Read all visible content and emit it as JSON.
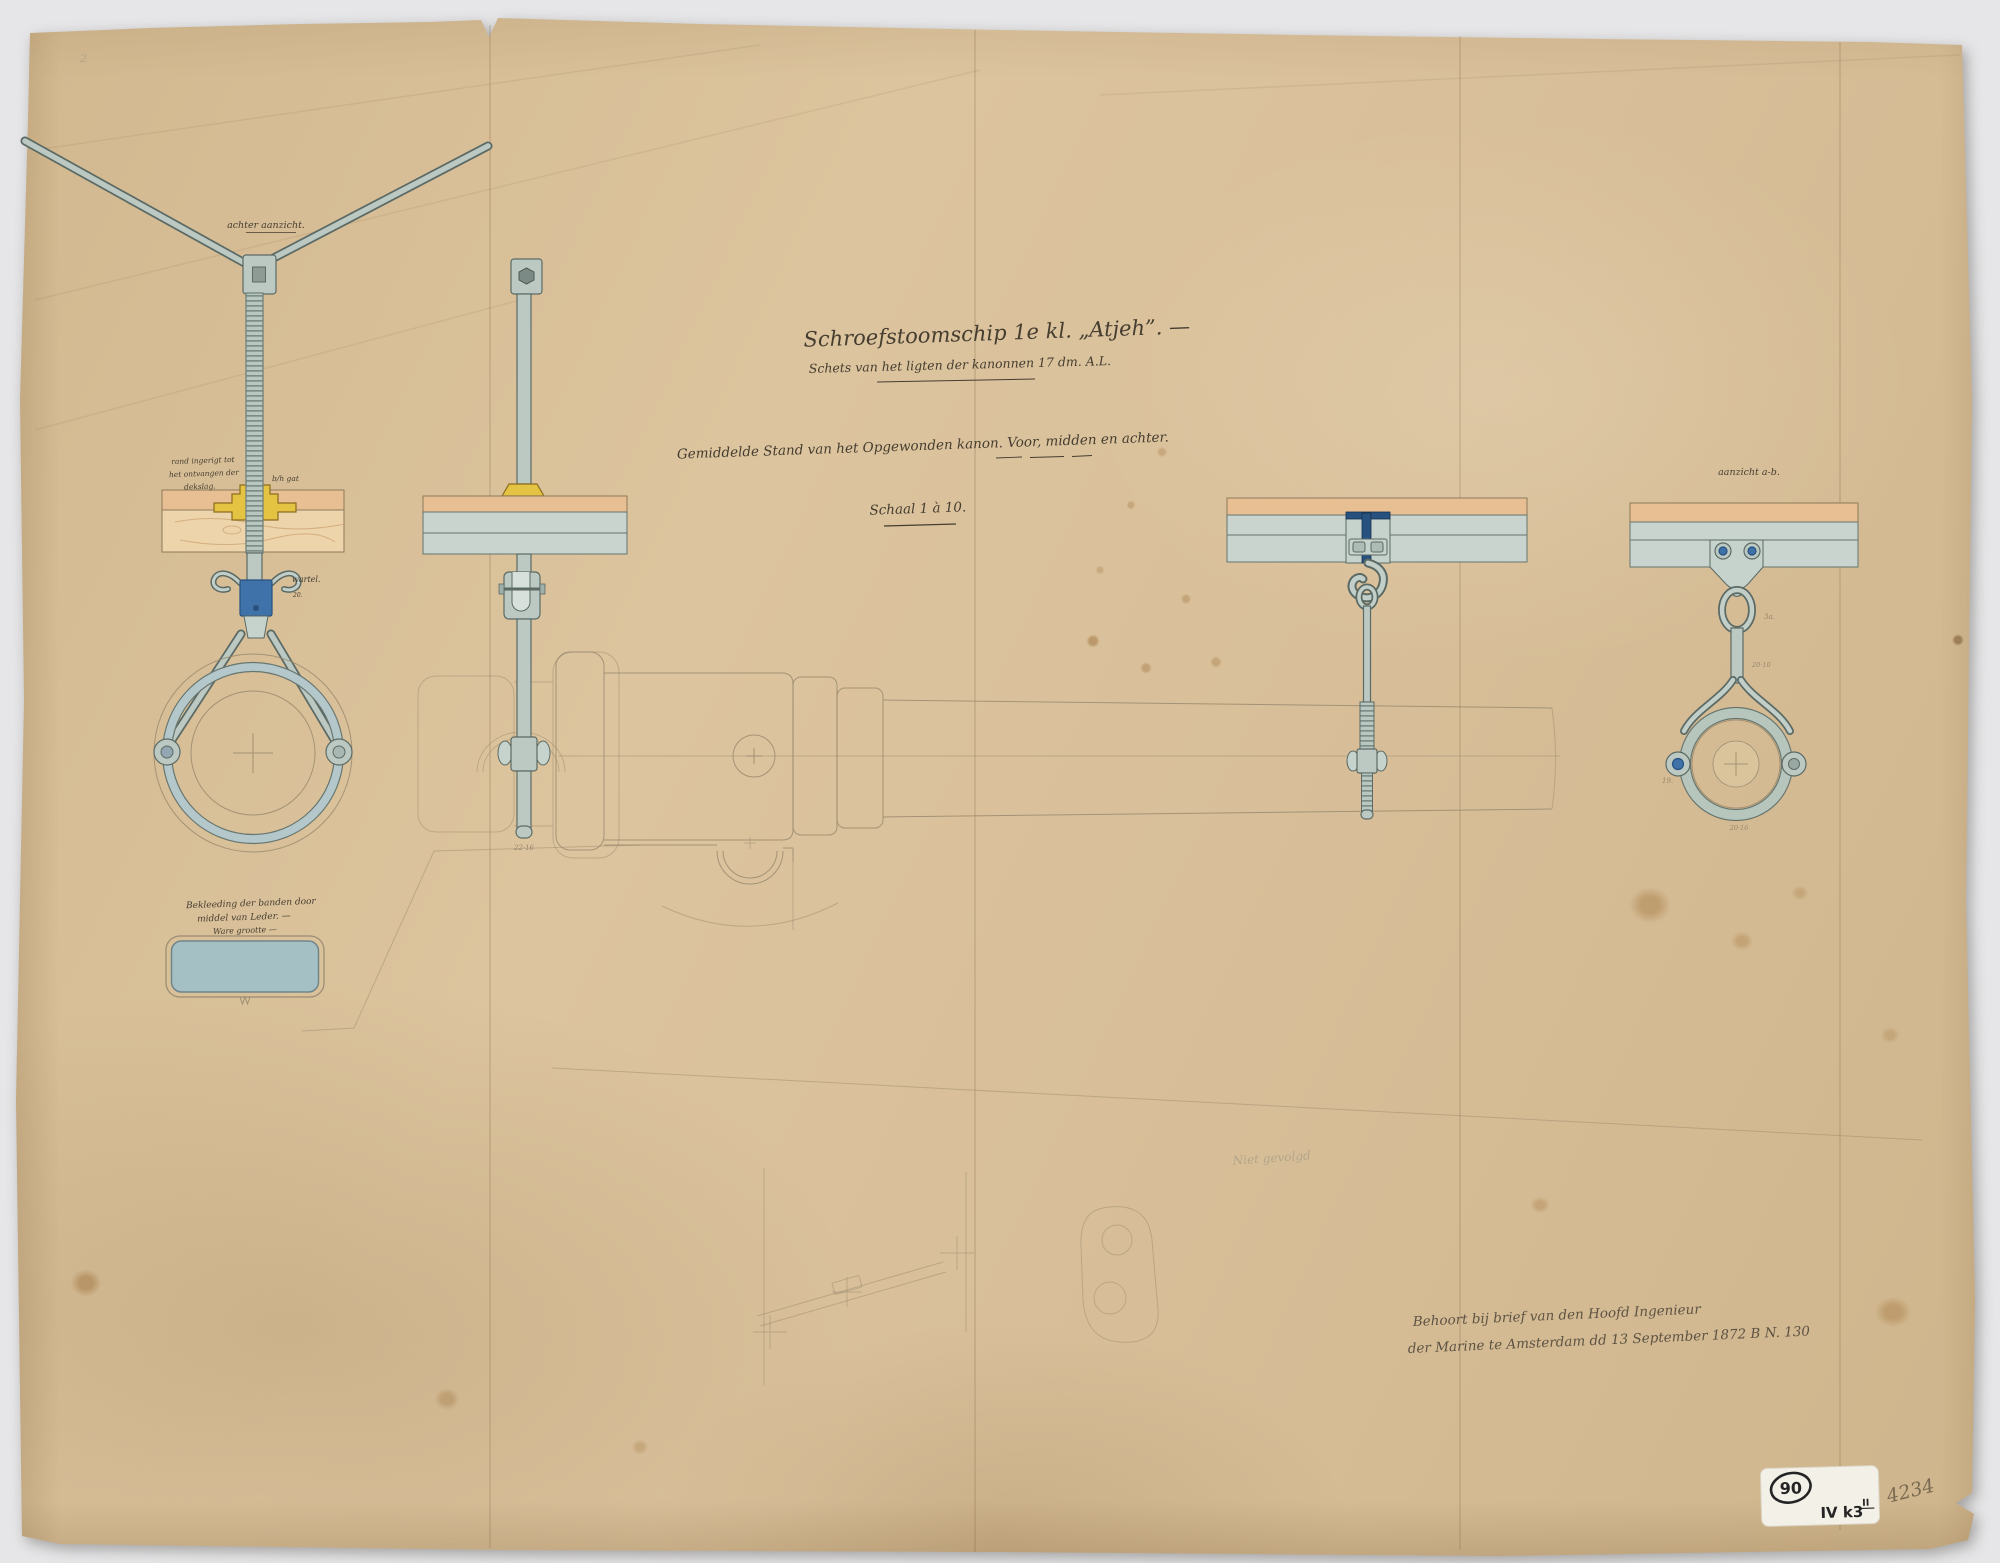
{
  "colors": {
    "ink": "#453d30",
    "ink-light": "#5d5344",
    "pencil": "#97876c",
    "pencil-faint": "#b3a58a",
    "metal": "#bcc9c3",
    "metal-light": "#c6d2cc",
    "metal-dark": "#5c6a65",
    "brass": "#e4c242",
    "brass-dark": "#8a6d1f",
    "wood": "#eed4ab",
    "wood-dark": "#e7bf92",
    "blue": "#3f72a8",
    "blue-dark": "#27517f",
    "band": "#9fc0ca",
    "deck": "#c8d4cd",
    "stamp-ink": "#242424",
    "pencil-number": "#7a6a52"
  },
  "titles": {
    "line1": "Schroefstoomschip 1e kl. „Atjeh”. —",
    "line2": "Schets van het ligten der kanonnen 17 dm. A.L.",
    "subtitle": "Gemiddelde Stand van het Opgewonden kanon. Voor, midden en achter.",
    "scale": "Schaal 1 à 10."
  },
  "views": {
    "rear": {
      "caption": "achter aanzicht.",
      "swivel": "wartel.",
      "swivel_size": "20.",
      "nut_note1": "rand ingerigt tot",
      "nut_note2": "het ontvangen der",
      "nut_note3": "dekslag.",
      "hole": "b/h gat"
    },
    "front_rod": {
      "rod_size": "22·16"
    },
    "muzzle": {
      "caption": "aanzicht a-b.",
      "link_size": "3a.",
      "shank_size": "20·10",
      "bolt_size": "19.",
      "band_size": "20·16"
    }
  },
  "leather": {
    "note1": "Bekleeding der banden door",
    "note2": "middel van Leder. —",
    "note3": "Ware grootte —"
  },
  "provenance": {
    "line1": "Behoort bij brief van den Hoofd Ingenieur",
    "line2": "der Marine te Amsterdam dd 13 September 1872 B N. 130"
  },
  "notes": {
    "pencil_note": "Niet gevolgd",
    "corner_mark": "2",
    "pencil_number": "4234"
  },
  "stamp": {
    "circled": "90",
    "code": "IV k3",
    "sup": "II"
  }
}
